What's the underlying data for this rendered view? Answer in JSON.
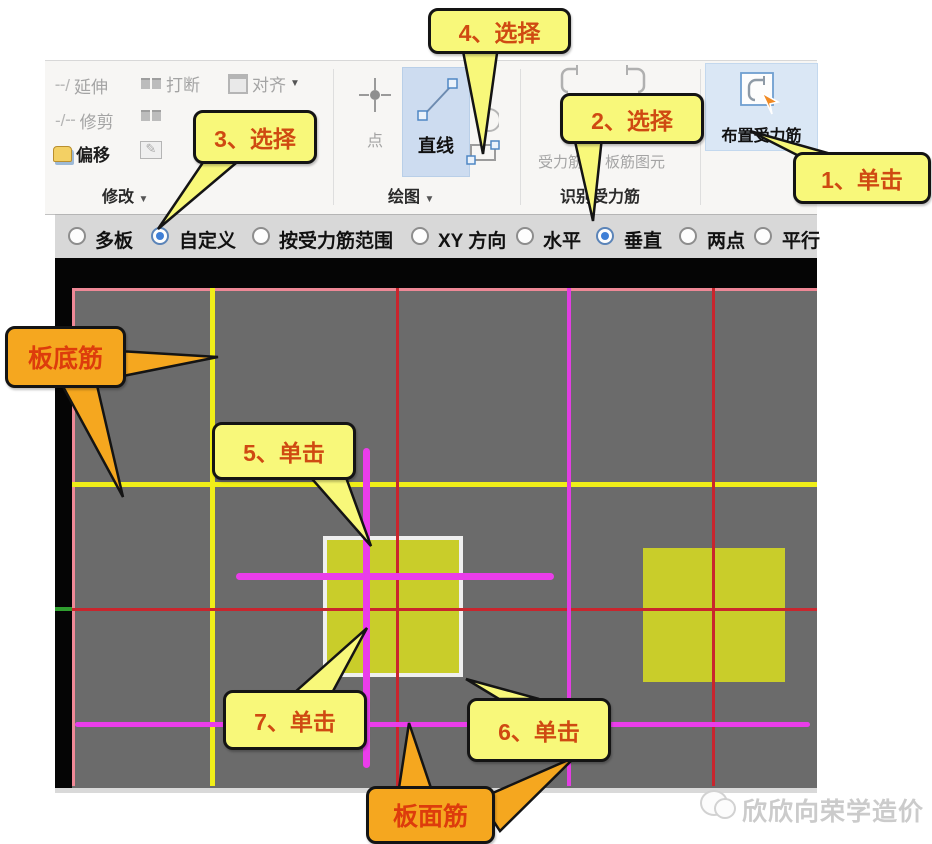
{
  "callouts": {
    "step1": "1、单击",
    "step2": "2、选择",
    "step3": "3、选择",
    "step4": "4、选择",
    "step5": "5、单击",
    "step6": "6、单击",
    "step7": "7、单击",
    "bottom_rebar": "板底筋",
    "top_rebar": "板面筋"
  },
  "toolbar": {
    "modify": {
      "group_label": "修改",
      "extend": "延伸",
      "break": "打断",
      "align": "对齐",
      "trim": "修剪",
      "offset": "偏移"
    },
    "draw": {
      "group_label": "绘图",
      "point": "点",
      "line": "直线"
    },
    "identify": {
      "group_label": "识别受力筋",
      "identify_rebar_line2": "受力筋",
      "identify_element_line2": "板筋图元"
    },
    "place_rebar": "布置受力筋"
  },
  "options_bar": {
    "items": [
      {
        "label": "多板",
        "selected": false
      },
      {
        "label": "自定义",
        "selected": true
      },
      {
        "label": "按受力筋范围",
        "selected": false
      },
      {
        "label": "XY 方向",
        "selected": false
      },
      {
        "label": "水平",
        "selected": false
      },
      {
        "label": "垂直",
        "selected": true
      },
      {
        "label": "两点",
        "selected": false
      },
      {
        "label": "平行",
        "selected": false
      }
    ]
  },
  "watermark": {
    "text": "欣欣向荣学造价"
  },
  "colors": {
    "slab_gray": "#6b6b6b",
    "bottom_rebar_yellow": "#f0ee18",
    "top_rebar_magenta": "#e23ee2",
    "grid_red": "#c9252d",
    "slab_border_pink": "#ee8896",
    "selected_square_fill": "#c9cd2a",
    "callout_yellow": "#f8f87a",
    "callout_orange": "#f5a71f",
    "highlight_blue": "#cddcf0"
  }
}
